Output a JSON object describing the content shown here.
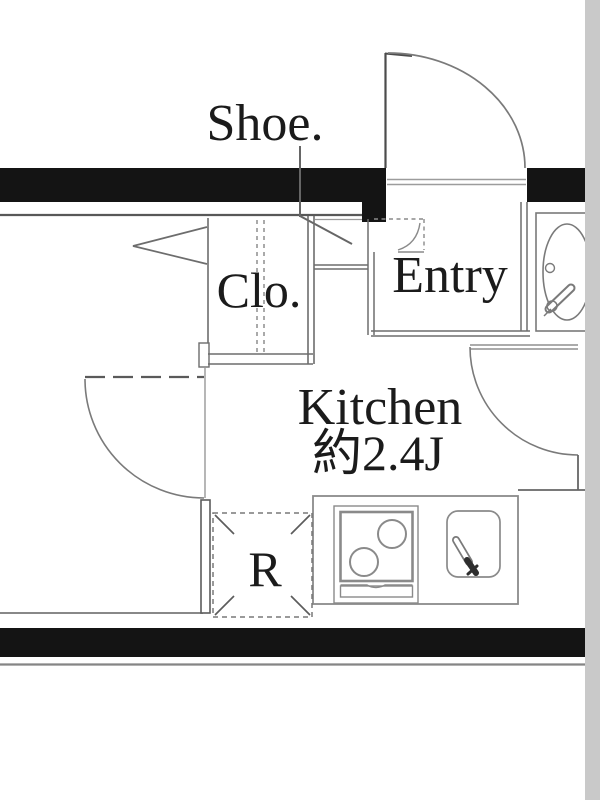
{
  "page": {
    "type": "apartment-floor-plan",
    "background": "#ffffff",
    "side_band_color": "#c9c9c9",
    "wall_color": "#141414",
    "line_color": "#707070",
    "text_color": "#1b1b1b"
  },
  "labels": {
    "shoe_cabinet": "Shoe.",
    "closet": "Clo.",
    "entry": "Entry",
    "kitchen_title": "Kitchen",
    "kitchen_area": "約2.4J",
    "refrigerator": "R"
  }
}
